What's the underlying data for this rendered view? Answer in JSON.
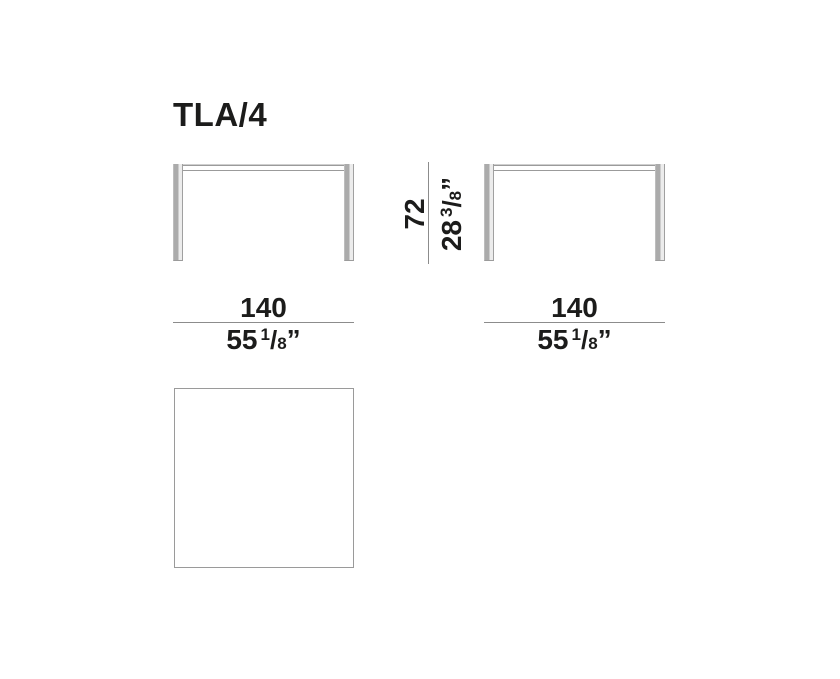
{
  "title": "TLA/4",
  "dims": {
    "height": {
      "metric": "72",
      "imperial": {
        "whole": "28",
        "num": "3",
        "slash": "/",
        "den": "8",
        "unit": "”"
      }
    },
    "width_left": {
      "metric": "140",
      "imperial": {
        "whole": "55",
        "num": "1",
        "slash": "/",
        "den": "8",
        "unit": "”"
      }
    },
    "width_right": {
      "metric": "140",
      "imperial": {
        "whole": "55",
        "num": "1",
        "slash": "/",
        "den": "8",
        "unit": "”"
      }
    }
  },
  "colors": {
    "background": "#ffffff",
    "text": "#1c1c1b",
    "dimension_line": "#8c8c8c",
    "leg_shade": "#ababab",
    "slab_edge": "#9b9b9b",
    "top_view_border": "#9a9a9a"
  }
}
